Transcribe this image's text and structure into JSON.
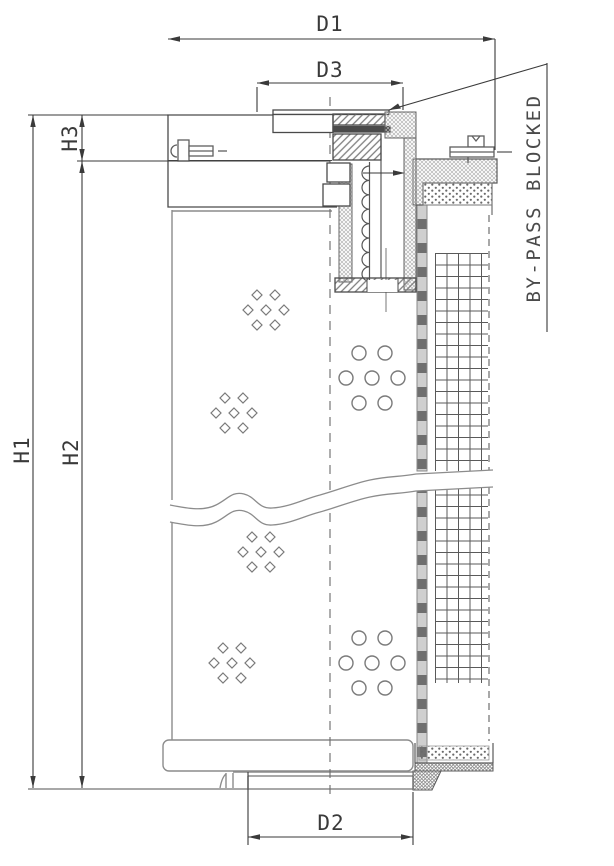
{
  "drawing": {
    "dimensions": {
      "d1": "D1",
      "d2": "D2",
      "d3": "D3",
      "h1": "H1",
      "h2": "H2",
      "h3": "H3"
    },
    "annotations": {
      "bypass_note": "BY-PASS BLOCKED"
    },
    "colors": {
      "background": "#ffffff",
      "dimension_lines": "#3a3a3a",
      "section_lines": "#4a4a4a",
      "outline_gray": "#8c8c8c",
      "hatch_gray": "#7d7d7d"
    }
  }
}
